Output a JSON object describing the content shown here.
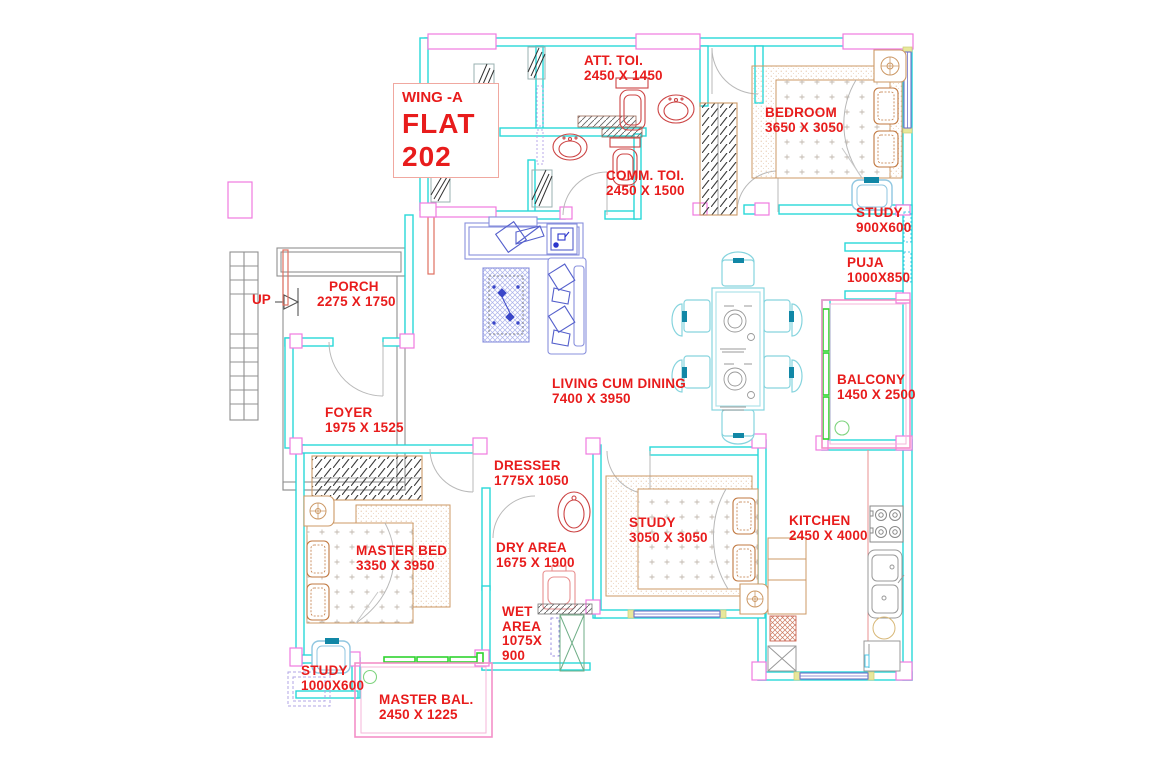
{
  "drawing": {
    "title_block": {
      "wing": "WING -A",
      "name": "FLAT",
      "number": "202"
    },
    "up_label": "UP",
    "rooms": [
      {
        "id": "att-toi",
        "name": "ATT. TOI.",
        "size": "2450 X 1450"
      },
      {
        "id": "comm-toi",
        "name": "COMM. TOI.",
        "size": "2450 X 1500"
      },
      {
        "id": "bedroom",
        "name": "BEDROOM",
        "size": "3650 X 3050"
      },
      {
        "id": "study-top",
        "name": "STUDY",
        "size": "900X600"
      },
      {
        "id": "puja",
        "name": "PUJA",
        "size": "1000X850"
      },
      {
        "id": "balcony",
        "name": "BALCONY",
        "size": "1450 X 2500"
      },
      {
        "id": "porch",
        "name": "PORCH",
        "size": "2275 X 1750"
      },
      {
        "id": "living",
        "name": "LIVING CUM DINING",
        "size": "7400 X 3950"
      },
      {
        "id": "foyer",
        "name": "FOYER",
        "size": "1975 X 1525"
      },
      {
        "id": "dresser",
        "name": "DRESSER",
        "size": "1775X 1050"
      },
      {
        "id": "master-bed",
        "name": "MASTER BED",
        "size": "3350 X 3950"
      },
      {
        "id": "dry-area",
        "name": "DRY AREA",
        "size": "1675 X 1900"
      },
      {
        "id": "study-mid",
        "name": "STUDY",
        "size": "3050 X 3050"
      },
      {
        "id": "kitchen",
        "name": "KITCHEN",
        "size": "2450 X 4000"
      },
      {
        "id": "wet-area",
        "name": "WET AREA",
        "size": "1075X 900"
      },
      {
        "id": "study-btm",
        "name": "STUDY",
        "size": "1000X600"
      },
      {
        "id": "master-bal",
        "name": "MASTER BAL.",
        "size": "2450 X 1225"
      }
    ],
    "palette": {
      "wall_cyan": "#29d8d8",
      "column_magenta": "#f060d8",
      "label_red": "#e81c1c",
      "furniture_tan": "#cc9966",
      "sanitary_red": "#cc4444",
      "living_blue": "#8890dd",
      "dining_cyan": "#86d4de",
      "teal_accent": "#1187a6",
      "window_green": "#2fd32f",
      "balcony_pink": "#f490c8",
      "porch_gray": "#909090",
      "window_blue": "#7070c8",
      "window_cap_yellow": "#e8e89a"
    }
  }
}
